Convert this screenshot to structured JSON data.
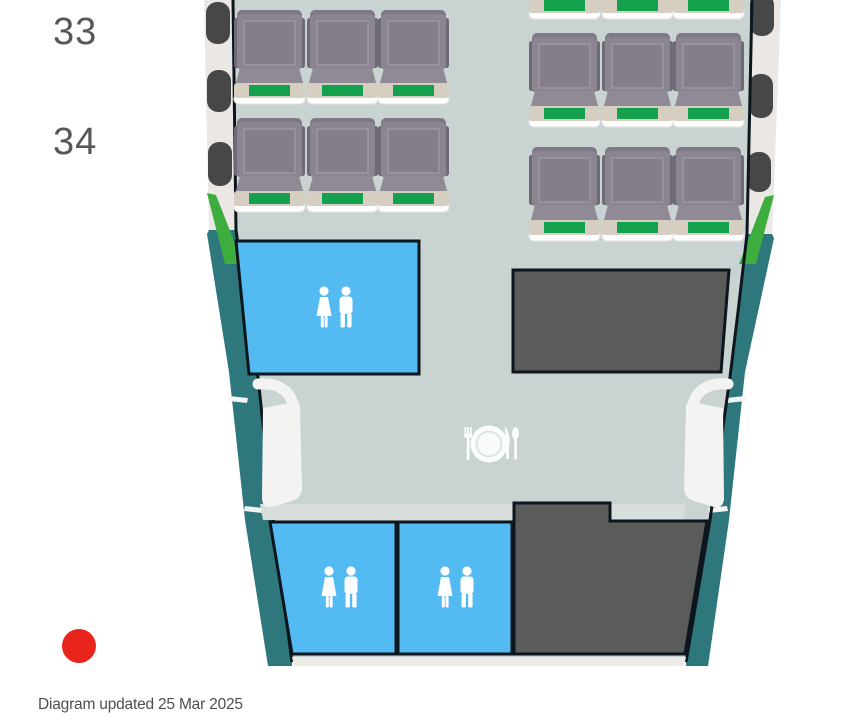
{
  "seatmap": {
    "rows": [
      {
        "number": "33"
      },
      {
        "number": "34"
      }
    ],
    "footer": {
      "updated_note": "Diagram updated 25 Mar 2025"
    },
    "marker": {
      "shape": "red-dot"
    },
    "icons": {
      "lavatory": "restroom-figures-icon",
      "galley_meal": "dining-plate-fork-knife-icon",
      "exit": "exit-door-icon",
      "window": "cabin-window-icon"
    },
    "colors": {
      "floor": "#C9D4D2",
      "bulkhead": "#D8DEDC",
      "hull": "#EAE7E4",
      "sliver": "#ECEAE6",
      "window": "#474747",
      "wall": "#2E777D",
      "stripe_green": "#3DAE3E",
      "outline": "#0D161C",
      "lavatory_blue": "#54BAF2",
      "galley_gray": "#5A5C5B",
      "door_white": "#F3F3F1",
      "tick_white": "#F2F4F3",
      "icon_white": "#FFFFFF",
      "seat_frame": "#8B8591",
      "seat_back_dark": "#7E7887",
      "seat_panel": "#847E8A",
      "seat_panel_edge": "#9C96A2",
      "seat_wing": "#6F6A77",
      "seat_cushion": "#908A96",
      "seat_trim": "#D6CEC0",
      "seat_green": "#13A14D",
      "seat_base": "#FDFDFD",
      "label_text": "#54585B",
      "footer_text": "#4B4F52",
      "red_marker": "#E8241C"
    }
  }
}
